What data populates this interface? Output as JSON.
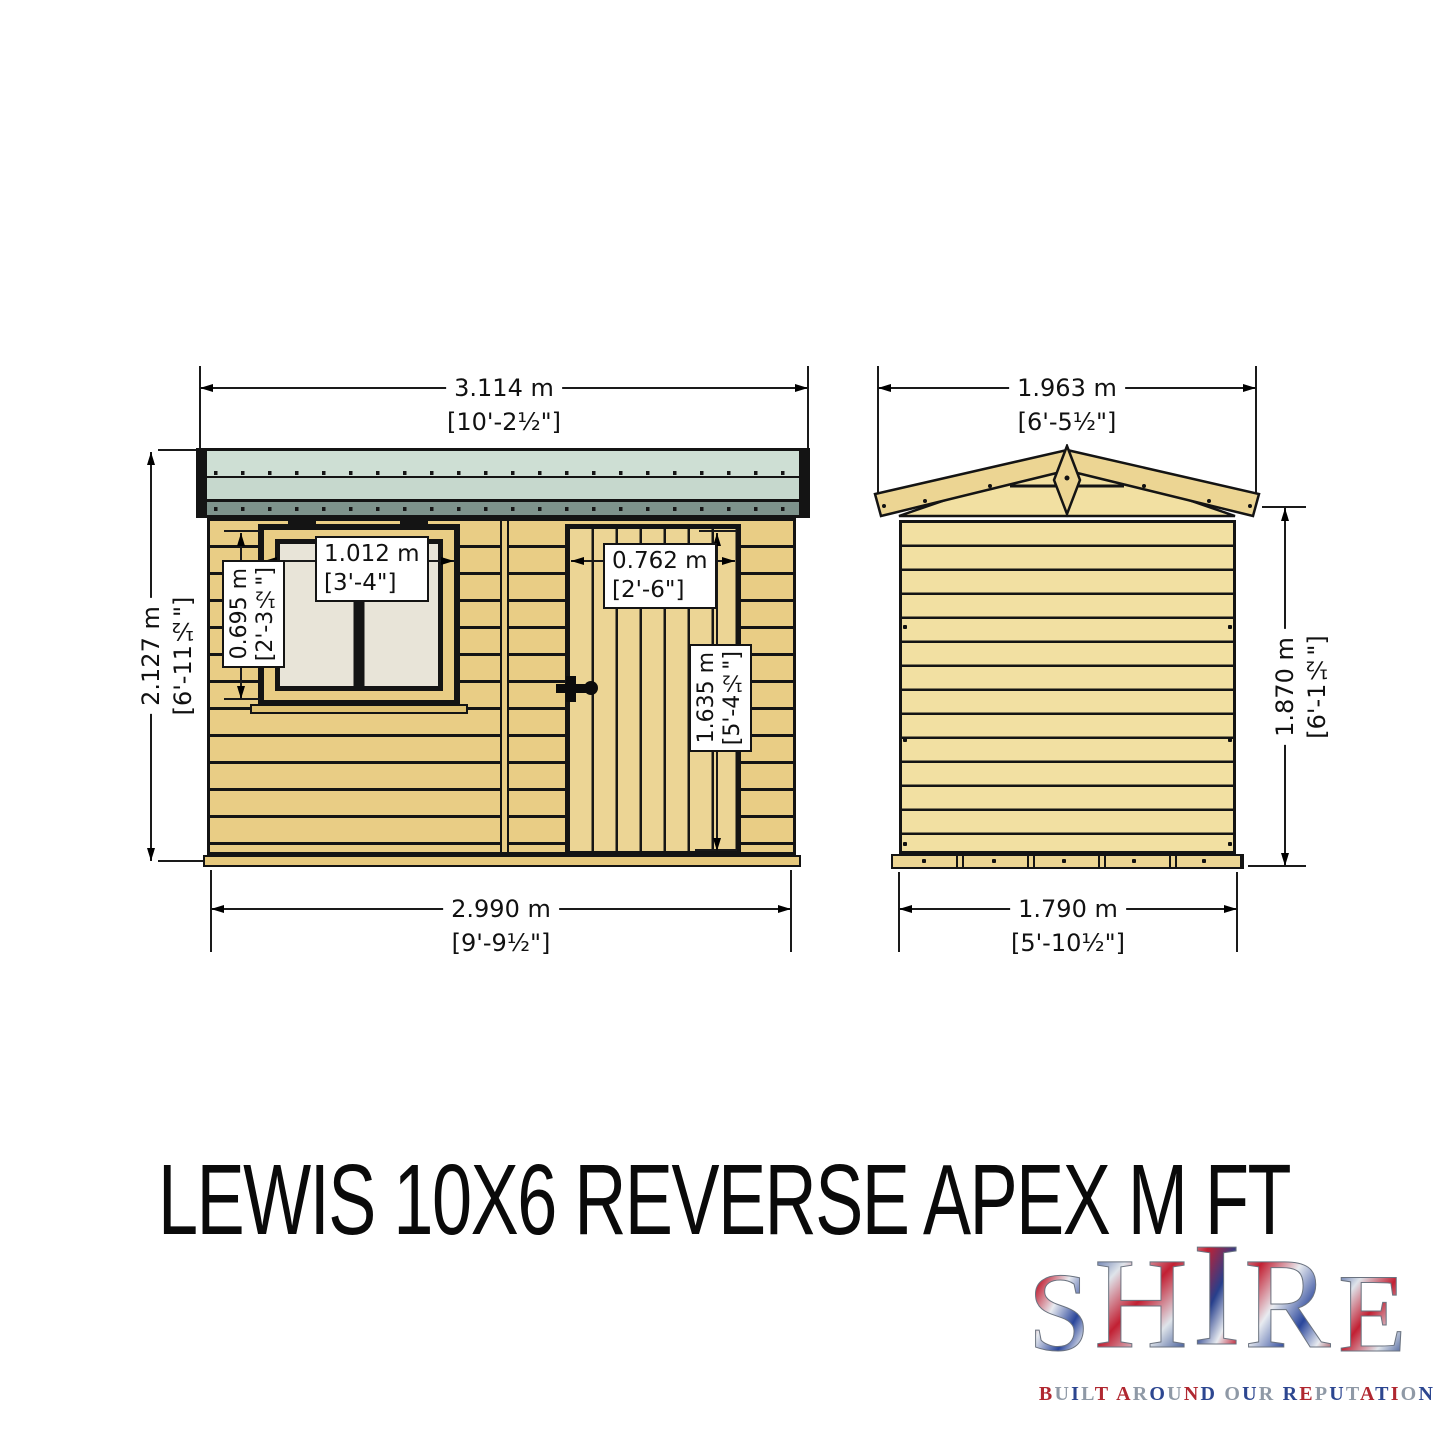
{
  "title": "LEWIS 10X6 REVERSE APEX M FT",
  "views": {
    "front": {
      "name": "front elevation",
      "width_top": {
        "metric": "3.114 m",
        "imperial": "[10'-2½\"]"
      },
      "height_left": {
        "metric": "2.127 m",
        "imperial": "[6'-11½\"]"
      },
      "width_bottom": {
        "metric": "2.990 m",
        "imperial": "[9'-9½\"]"
      },
      "window_width": {
        "metric": "1.012 m",
        "imperial": "[3'-4\"]"
      },
      "window_height": {
        "metric": "0.695 m",
        "imperial": "[2'-3½\"]"
      },
      "door_width": {
        "metric": "0.762 m",
        "imperial": "[2'-6\"]"
      },
      "door_height": {
        "metric": "1.635 m",
        "imperial": "[5'-4½\"]"
      }
    },
    "side": {
      "name": "gable end elevation",
      "width_top": {
        "metric": "1.963 m",
        "imperial": "[6'-5½\"]"
      },
      "height_right": {
        "metric": "1.870 m",
        "imperial": "[6'-1½\"]"
      },
      "width_bottom": {
        "metric": "1.790 m",
        "imperial": "[5'-10½\"]"
      }
    }
  },
  "logo": {
    "brand": "SHIRE",
    "letters": [
      "S",
      "H",
      "I",
      "R",
      "E"
    ],
    "tagline": "BUILT AROUND OUR REPUTATION"
  },
  "colors": {
    "outline": "#141414",
    "roof_felt": "#cedfd4",
    "roof_felt2": "#c6d8cd",
    "roof_fascia": "#7e938c",
    "timber": "#e9cd85",
    "timber_light": "#f2e0a2",
    "pane": "#e8e4d8",
    "flag_red": "#b02730",
    "flag_blue": "#2c4690",
    "flag_silver": "#8f99a6"
  }
}
